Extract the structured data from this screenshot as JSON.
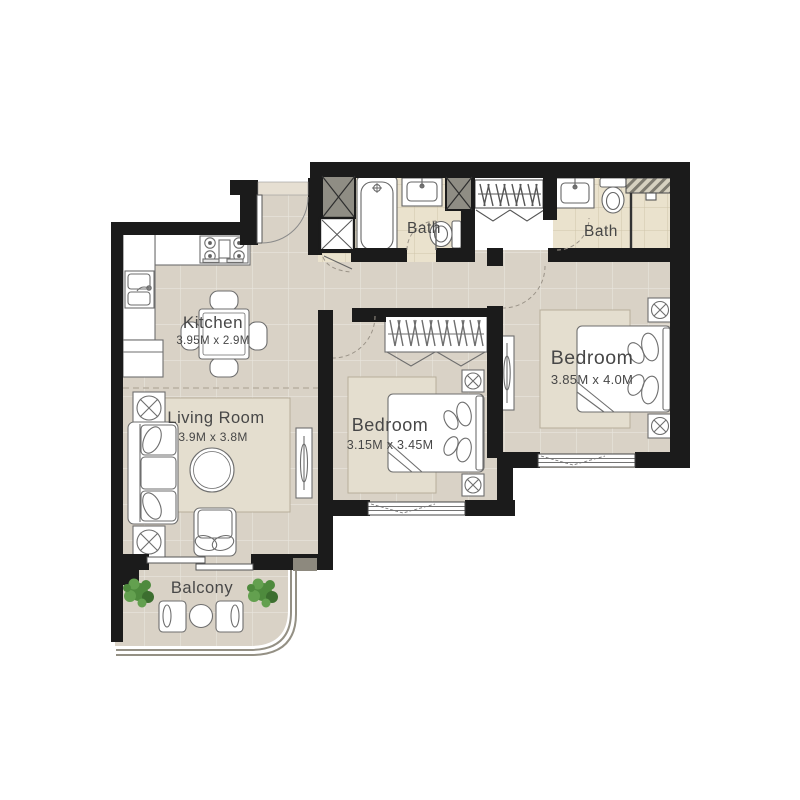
{
  "plan": {
    "type": "apartment-floor-plan",
    "rooms": {
      "kitchen": {
        "name": "Kitchen",
        "dimensions": "3.95M x 2.9M"
      },
      "living_room": {
        "name": "Living Room",
        "dimensions": "3.9M x 3.8M"
      },
      "bedroom_small": {
        "name": "Bedroom",
        "dimensions": "3.15M x 3.45M"
      },
      "bedroom_master": {
        "name": "Bedroom",
        "dimensions": "3.85M x 4.0M"
      },
      "bath_1": {
        "name": "Bath"
      },
      "bath_2": {
        "name": "Bath"
      },
      "balcony": {
        "name": "Balcony"
      }
    },
    "colors": {
      "wall": "#1b1b1b",
      "floor": "#d9d2c6",
      "bath_floor": "#eae2cd",
      "rug": "#e4decf",
      "structural_column": "#8f8d84",
      "plant_green": "#4e8a3d",
      "label_text": "#474747"
    }
  }
}
